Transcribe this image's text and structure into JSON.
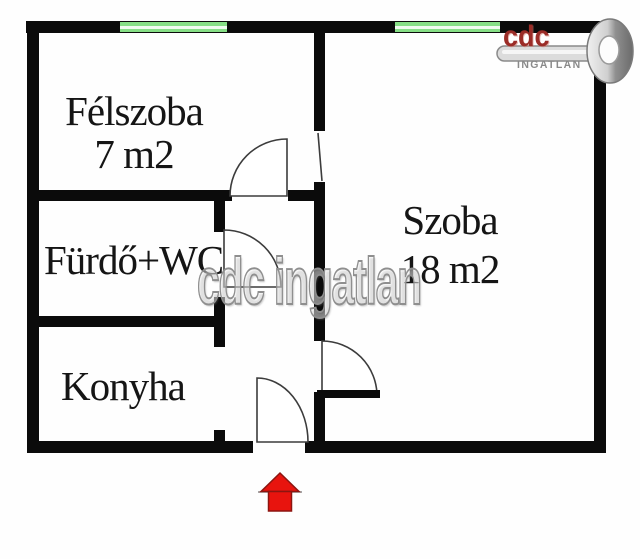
{
  "rooms": {
    "felszoba": {
      "name": "Félszoba",
      "area": "7 m2"
    },
    "furdo_wc": {
      "name": "Fürdő+WC"
    },
    "konyha": {
      "name": "Konyha"
    },
    "szoba": {
      "name": "Szoba",
      "area": "18 m2"
    }
  },
  "watermark": {
    "text": "cdc ingatlan"
  },
  "logo": {
    "brand": "cdc",
    "subtitle": "INGATLAN"
  },
  "colors": {
    "wall": "#0b0b0b",
    "window_green": "#86df86",
    "door_line": "#3c3c3c",
    "watermark_gray": "#8f8f8f",
    "logo_red": "#9b2c27",
    "logo_gray": "#8a8a8a",
    "arrow_red": "#e8140e"
  }
}
